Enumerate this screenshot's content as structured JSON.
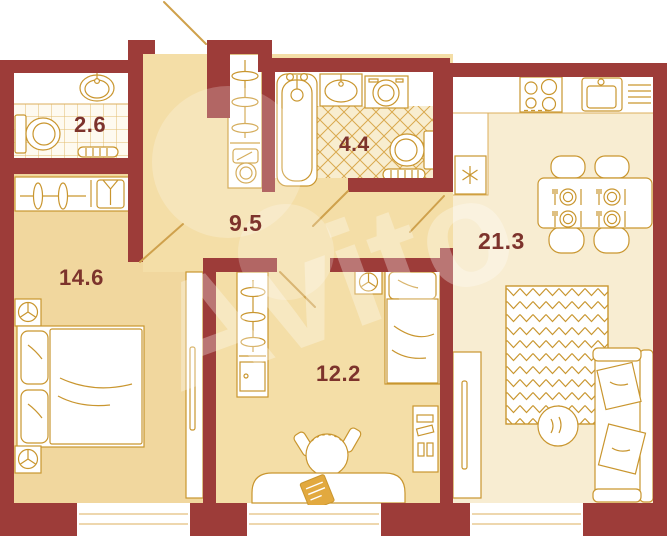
{
  "plan": {
    "watermark": "Avito",
    "rooms": [
      {
        "name": "wc",
        "area": "2.6"
      },
      {
        "name": "bathroom",
        "area": "4.4"
      },
      {
        "name": "hallway",
        "area": "9.5"
      },
      {
        "name": "bedroom",
        "area": "14.6"
      },
      {
        "name": "kitchen-living-room",
        "area": "21.3"
      },
      {
        "name": "bedroom-2",
        "area": "12.2"
      }
    ],
    "colors": {
      "wall": "#9D3C39",
      "outline": "#C9962F",
      "tile-line": "#DCAF5C",
      "floor": "#F4DEA7",
      "floor-bedroom": "#F1D79E",
      "floor-light": "#F8EDD2",
      "label": "#7D332C"
    },
    "icons": {
      "bathtub-icon": "bathtub outline",
      "toilet-icon": "toilet outline",
      "sink-icon": "wash basin",
      "washing-machine-icon": "square with drum circle",
      "stove-icon": "4 burner cooktop",
      "fridge-icon": "snowflake asterisk",
      "hanger-icon": "clothes hanger ellipse",
      "shirt-icon": "folded shirt",
      "door-swing-icon": "diagonal door leaf",
      "window-icon": "white band in wall"
    }
  }
}
